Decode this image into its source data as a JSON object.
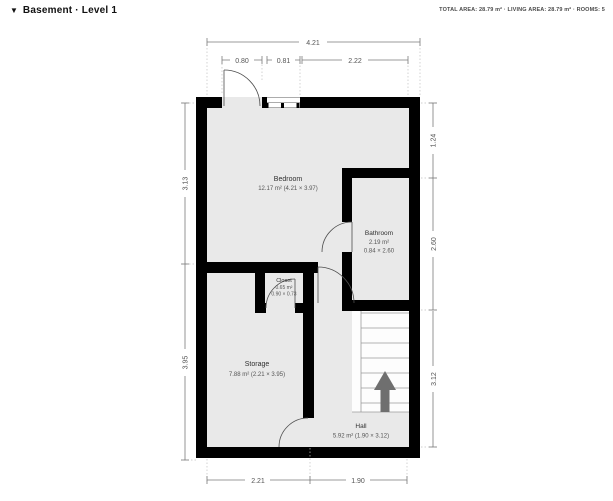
{
  "header": {
    "dropdown_icon": "▼",
    "level_label": "Basement · Level 1",
    "stats": "TOTAL AREA: 28.79 m² · LIVING AREA: 28.79 m² · ROOMS: 5"
  },
  "rooms": [
    {
      "name": "Bedroom",
      "area": "12.17 m² (4.21 × 3.97)"
    },
    {
      "name": "Bathroom",
      "area": "2.19 m²",
      "size": "0.84 × 2.60"
    },
    {
      "name": "Closet",
      "area": "0.65 m²",
      "size": "0.90 × 0.73"
    },
    {
      "name": "Storage",
      "area": "7.88 m² (2.21 × 3.95)"
    },
    {
      "name": "Hall",
      "area": "5.92 m² (1.90 × 3.12)"
    }
  ],
  "dimensions": {
    "top_total": "4.21",
    "top_door": "0.80",
    "top_window": "0.81",
    "top_right": "2.22",
    "left_upper": "3.13",
    "left_lower": "3.95",
    "right_upper": "1.24",
    "right_middle": "2.60",
    "right_lower": "3.12",
    "bottom_left": "2.21",
    "bottom_right": "1.90"
  },
  "icons": {
    "level_dropdown": "triangle-down",
    "stairs_direction": "up-arrow"
  },
  "colors": {
    "wall": "#000000",
    "floor": "#e9e9e9",
    "dimension": "#7a7a7a",
    "stairs_arrow": "#6f6f6f"
  }
}
